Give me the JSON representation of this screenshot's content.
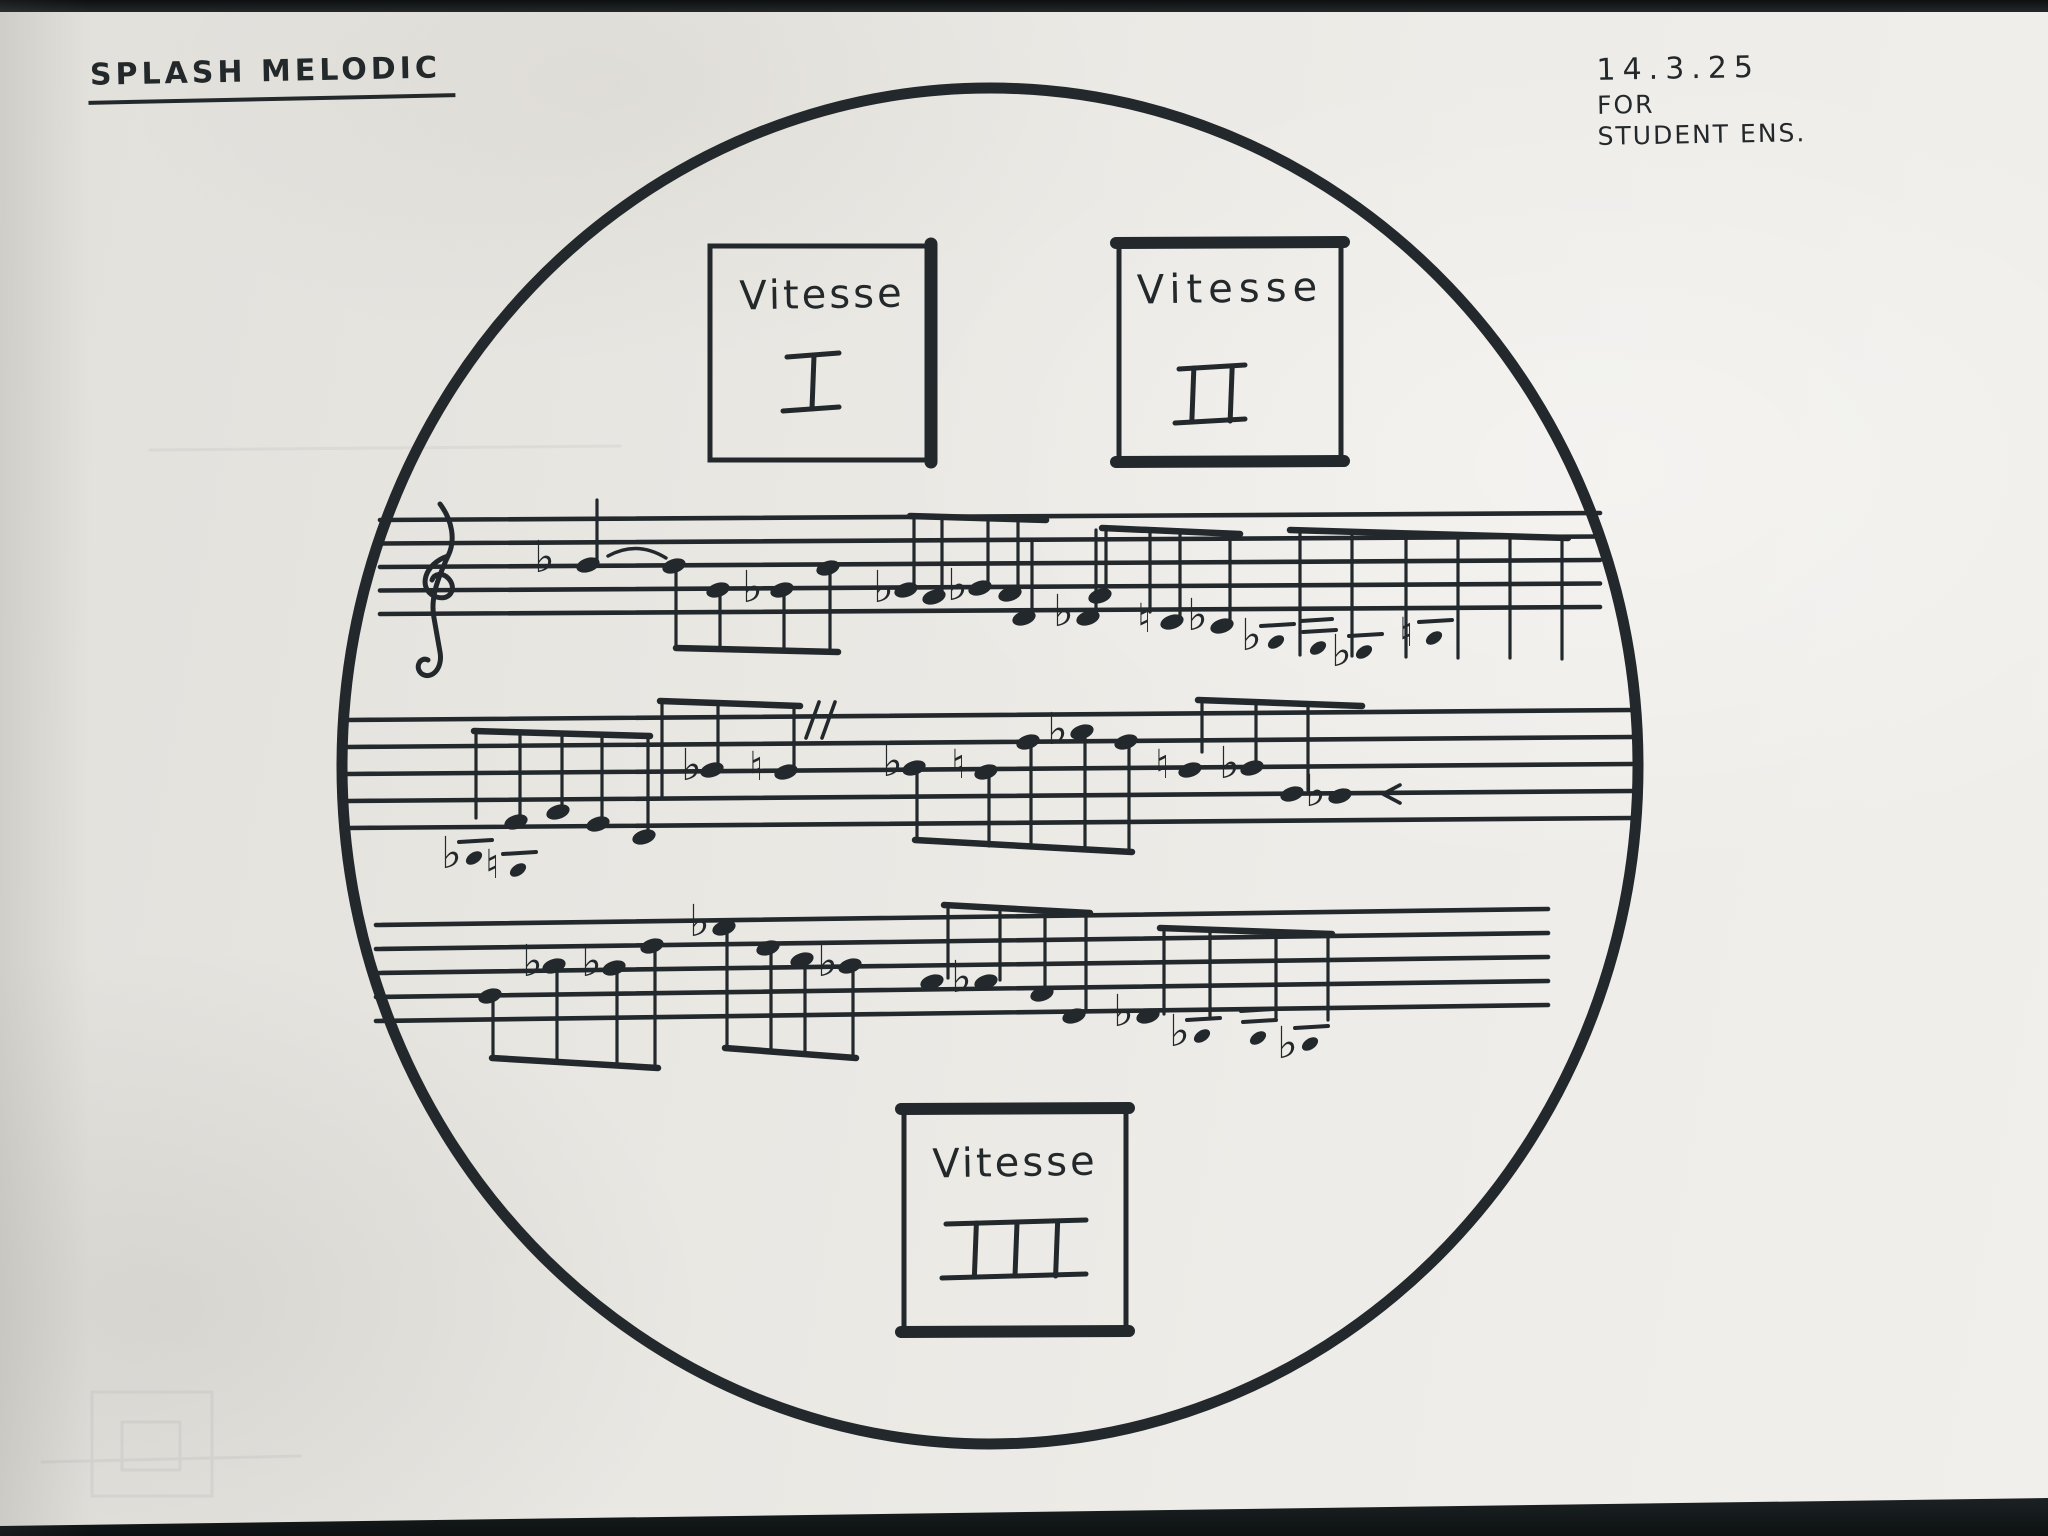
{
  "header": {
    "title": "SPLASH MELODIC",
    "date": "14.3.25",
    "for_line": "FOR",
    "ensemble_line": "STUDENT ENS."
  },
  "colors": {
    "ink": "#22282b",
    "paper": "#ebe9e4",
    "background_strip": "#15191b"
  },
  "boxes": [
    {
      "label": "Vitesse",
      "numeral": "I",
      "x": 710,
      "y": 246,
      "w": 224,
      "h": 214,
      "thick": "right",
      "num_cx": 813,
      "num_cy": 382,
      "num_w": 52
    },
    {
      "label": "Vitesse",
      "numeral": "II",
      "x": 1119,
      "y": 242,
      "w": 222,
      "h": 220,
      "thick": "top-bottom",
      "num_cx": 1212,
      "num_cy": 394,
      "num_w": 66
    },
    {
      "label": "Vitesse",
      "numeral": "III",
      "x": 904,
      "y": 1108,
      "w": 222,
      "h": 224,
      "thick": "top-bottom",
      "num_cx": 1016,
      "num_cy": 1249,
      "num_w": 140
    }
  ],
  "score": {
    "circle": {
      "cx": 990,
      "cy": 766,
      "rx": 648,
      "ry": 678,
      "stroke_w": 11
    },
    "staves": [
      {
        "x1": 380,
        "x2": 1600,
        "top": 520,
        "gap": 23.5,
        "tilt": -7,
        "elements": [
          {
            "t": "clef",
            "x": 436,
            "y": 586
          },
          {
            "t": "flat",
            "x": 545,
            "y": 556
          },
          {
            "t": "head",
            "x": 588,
            "y": 565
          },
          {
            "t": "stem",
            "x": 597,
            "y1": 500,
            "y2": 562
          },
          {
            "t": "tie",
            "x1": 608,
            "y1": 556,
            "x2": 666,
            "y2": 558,
            "dy": -16
          },
          {
            "t": "head",
            "x": 674,
            "y": 566
          },
          {
            "t": "stem",
            "x": 676,
            "y1": 570,
            "y2": 648
          },
          {
            "t": "head",
            "x": 718,
            "y": 590
          },
          {
            "t": "stem",
            "x": 720,
            "y1": 594,
            "y2": 649
          },
          {
            "t": "flat",
            "x": 753,
            "y": 586
          },
          {
            "t": "head",
            "x": 782,
            "y": 590
          },
          {
            "t": "stem",
            "x": 784,
            "y1": 594,
            "y2": 650
          },
          {
            "t": "head",
            "x": 828,
            "y": 568
          },
          {
            "t": "stem",
            "x": 830,
            "y1": 572,
            "y2": 650
          },
          {
            "t": "beam",
            "x1": 676,
            "y1": 648,
            "x2": 838,
            "y2": 652
          },
          {
            "t": "flat",
            "x": 884,
            "y": 586
          },
          {
            "t": "head",
            "x": 906,
            "y": 590
          },
          {
            "t": "stem",
            "x": 914,
            "y1": 516,
            "y2": 586
          },
          {
            "t": "head",
            "x": 934,
            "y": 597
          },
          {
            "t": "stem",
            "x": 942,
            "y1": 517,
            "y2": 593
          },
          {
            "t": "flat",
            "x": 958,
            "y": 584
          },
          {
            "t": "head",
            "x": 980,
            "y": 588
          },
          {
            "t": "stem",
            "x": 988,
            "y1": 518,
            "y2": 584
          },
          {
            "t": "head",
            "x": 1010,
            "y": 594
          },
          {
            "t": "stem",
            "x": 1018,
            "y1": 519,
            "y2": 590
          },
          {
            "t": "beam",
            "x1": 910,
            "y1": 516,
            "x2": 1046,
            "y2": 520
          },
          {
            "t": "head",
            "x": 1024,
            "y": 618
          },
          {
            "t": "stem",
            "x": 1032,
            "y1": 540,
            "y2": 614
          },
          {
            "t": "flat",
            "x": 1064,
            "y": 610
          },
          {
            "t": "head",
            "x": 1088,
            "y": 618
          },
          {
            "t": "stem",
            "x": 1096,
            "y1": 530,
            "y2": 614
          },
          {
            "t": "beam",
            "x1": 1102,
            "y1": 528,
            "x2": 1240,
            "y2": 534
          },
          {
            "t": "head",
            "x": 1100,
            "y": 596
          },
          {
            "t": "stem",
            "x": 1106,
            "y1": 530,
            "y2": 592
          },
          {
            "t": "stem",
            "x": 1150,
            "y1": 531,
            "y2": 612
          },
          {
            "t": "nat",
            "x": 1148,
            "y": 618
          },
          {
            "t": "head",
            "x": 1172,
            "y": 622
          },
          {
            "t": "stem",
            "x": 1180,
            "y1": 532,
            "y2": 618
          },
          {
            "t": "flat",
            "x": 1198,
            "y": 614
          },
          {
            "t": "head",
            "x": 1222,
            "y": 626
          },
          {
            "t": "stem",
            "x": 1230,
            "y1": 533,
            "y2": 622
          },
          {
            "t": "flat",
            "x": 1252,
            "y": 634
          },
          {
            "t": "bar",
            "x": 1276,
            "y": 642
          },
          {
            "t": "bar",
            "x": 1318,
            "y": 648,
            "b2": true
          },
          {
            "t": "flat",
            "x": 1342,
            "y": 650
          },
          {
            "t": "bar",
            "x": 1364,
            "y": 652
          },
          {
            "t": "nat",
            "x": 1410,
            "y": 632
          },
          {
            "t": "bar",
            "x": 1434,
            "y": 638
          },
          {
            "t": "beam",
            "x1": 1290,
            "y1": 530,
            "x2": 1568,
            "y2": 538
          },
          {
            "t": "stem",
            "x": 1300,
            "y1": 532,
            "y2": 655
          },
          {
            "t": "stem",
            "x": 1352,
            "y1": 533,
            "y2": 656
          },
          {
            "t": "stem",
            "x": 1406,
            "y1": 534,
            "y2": 657
          },
          {
            "t": "stem",
            "x": 1458,
            "y1": 535,
            "y2": 658
          },
          {
            "t": "stem",
            "x": 1510,
            "y1": 536,
            "y2": 658
          },
          {
            "t": "stem",
            "x": 1562,
            "y1": 537,
            "y2": 659
          }
        ]
      },
      {
        "x1": 348,
        "x2": 1632,
        "top": 720,
        "gap": 27,
        "tilt": -10,
        "elements": [
          {
            "t": "flat",
            "x": 452,
            "y": 852
          },
          {
            "t": "bar",
            "x": 474,
            "y": 858
          },
          {
            "t": "nat",
            "x": 496,
            "y": 864
          },
          {
            "t": "bar",
            "x": 518,
            "y": 870
          },
          {
            "t": "beam",
            "x1": 474,
            "y1": 731,
            "x2": 650,
            "y2": 736
          },
          {
            "t": "stem",
            "x": 476,
            "y1": 733,
            "y2": 818
          },
          {
            "t": "stem",
            "x": 520,
            "y1": 733,
            "y2": 818
          },
          {
            "t": "head",
            "x": 516,
            "y": 822
          },
          {
            "t": "stem",
            "x": 562,
            "y1": 734,
            "y2": 808
          },
          {
            "t": "head",
            "x": 558,
            "y": 812
          },
          {
            "t": "stem",
            "x": 602,
            "y1": 734,
            "y2": 820
          },
          {
            "t": "head",
            "x": 598,
            "y": 824
          },
          {
            "t": "stem",
            "x": 648,
            "y1": 735,
            "y2": 833
          },
          {
            "t": "head",
            "x": 644,
            "y": 837
          },
          {
            "t": "beam",
            "x1": 660,
            "y1": 701,
            "x2": 800,
            "y2": 706
          },
          {
            "t": "stem",
            "x": 662,
            "y1": 703,
            "y2": 798
          },
          {
            "t": "flat",
            "x": 692,
            "y": 764
          },
          {
            "t": "head",
            "x": 712,
            "y": 770
          },
          {
            "t": "stem",
            "x": 718,
            "y1": 704,
            "y2": 766
          },
          {
            "t": "nat",
            "x": 760,
            "y": 766
          },
          {
            "t": "head",
            "x": 786,
            "y": 772
          },
          {
            "t": "stem",
            "x": 794,
            "y1": 705,
            "y2": 768
          },
          {
            "t": "caes",
            "x": 806,
            "y": 716
          },
          {
            "t": "flat",
            "x": 893,
            "y": 760
          },
          {
            "t": "head",
            "x": 914,
            "y": 768
          },
          {
            "t": "stem",
            "x": 917,
            "y1": 772,
            "y2": 838
          },
          {
            "t": "nat",
            "x": 962,
            "y": 764
          },
          {
            "t": "head",
            "x": 986,
            "y": 772
          },
          {
            "t": "stem",
            "x": 989,
            "y1": 776,
            "y2": 846
          },
          {
            "t": "head",
            "x": 1028,
            "y": 742
          },
          {
            "t": "stem",
            "x": 1031,
            "y1": 746,
            "y2": 848
          },
          {
            "t": "flat",
            "x": 1058,
            "y": 728
          },
          {
            "t": "head",
            "x": 1082,
            "y": 732
          },
          {
            "t": "stem",
            "x": 1085,
            "y1": 736,
            "y2": 850
          },
          {
            "t": "head",
            "x": 1126,
            "y": 742
          },
          {
            "t": "stem",
            "x": 1129,
            "y1": 746,
            "y2": 852
          },
          {
            "t": "beam",
            "x1": 915,
            "y1": 840,
            "x2": 1132,
            "y2": 852
          },
          {
            "t": "beam",
            "x1": 1198,
            "y1": 700,
            "x2": 1362,
            "y2": 706
          },
          {
            "t": "stem",
            "x": 1202,
            "y1": 702,
            "y2": 752
          },
          {
            "t": "nat",
            "x": 1166,
            "y": 764
          },
          {
            "t": "head",
            "x": 1190,
            "y": 770
          },
          {
            "t": "stem",
            "x": 1256,
            "y1": 703,
            "y2": 766
          },
          {
            "t": "flat",
            "x": 1230,
            "y": 762
          },
          {
            "t": "head",
            "x": 1252,
            "y": 768
          },
          {
            "t": "stem",
            "x": 1308,
            "y1": 704,
            "y2": 790
          },
          {
            "t": "head",
            "x": 1292,
            "y": 794
          },
          {
            "t": "flat",
            "x": 1316,
            "y": 790
          },
          {
            "t": "head",
            "x": 1340,
            "y": 796
          },
          {
            "t": "arrow",
            "x": 1383,
            "y": 794
          }
        ]
      },
      {
        "x1": 376,
        "x2": 1548,
        "top": 925,
        "gap": 24,
        "tilt": -16,
        "elements": [
          {
            "t": "head",
            "x": 490,
            "y": 996
          },
          {
            "t": "stem",
            "x": 493,
            "y1": 1000,
            "y2": 1058
          },
          {
            "t": "flat",
            "x": 533,
            "y": 960
          },
          {
            "t": "head",
            "x": 554,
            "y": 966
          },
          {
            "t": "stem",
            "x": 557,
            "y1": 970,
            "y2": 1062
          },
          {
            "t": "flat",
            "x": 592,
            "y": 960
          },
          {
            "t": "head",
            "x": 614,
            "y": 968
          },
          {
            "t": "stem",
            "x": 617,
            "y1": 972,
            "y2": 1064
          },
          {
            "t": "head",
            "x": 652,
            "y": 946
          },
          {
            "t": "stem",
            "x": 655,
            "y1": 950,
            "y2": 1066
          },
          {
            "t": "beam",
            "x1": 492,
            "y1": 1058,
            "x2": 658,
            "y2": 1068
          },
          {
            "t": "flat",
            "x": 700,
            "y": 920
          },
          {
            "t": "head",
            "x": 724,
            "y": 928
          },
          {
            "t": "stem",
            "x": 727,
            "y1": 932,
            "y2": 1048
          },
          {
            "t": "head",
            "x": 768,
            "y": 948
          },
          {
            "t": "stem",
            "x": 771,
            "y1": 952,
            "y2": 1050
          },
          {
            "t": "head",
            "x": 802,
            "y": 960
          },
          {
            "t": "stem",
            "x": 805,
            "y1": 964,
            "y2": 1053
          },
          {
            "t": "flat",
            "x": 828,
            "y": 960
          },
          {
            "t": "head",
            "x": 850,
            "y": 966
          },
          {
            "t": "stem",
            "x": 853,
            "y1": 970,
            "y2": 1056
          },
          {
            "t": "beam",
            "x1": 725,
            "y1": 1048,
            "x2": 856,
            "y2": 1058
          },
          {
            "t": "beam",
            "x1": 944,
            "y1": 905,
            "x2": 1090,
            "y2": 913
          },
          {
            "t": "head",
            "x": 932,
            "y": 982
          },
          {
            "t": "stem",
            "x": 948,
            "y1": 907,
            "y2": 978
          },
          {
            "t": "flat",
            "x": 962,
            "y": 976
          },
          {
            "t": "head",
            "x": 986,
            "y": 982
          },
          {
            "t": "stem",
            "x": 1000,
            "y1": 909,
            "y2": 980
          },
          {
            "t": "head",
            "x": 1042,
            "y": 994
          },
          {
            "t": "stem",
            "x": 1045,
            "y1": 911,
            "y2": 990
          },
          {
            "t": "head",
            "x": 1074,
            "y": 1016
          },
          {
            "t": "stem",
            "x": 1086,
            "y1": 912,
            "y2": 1012
          },
          {
            "t": "flat",
            "x": 1124,
            "y": 1010
          },
          {
            "t": "head",
            "x": 1148,
            "y": 1016
          },
          {
            "t": "beam",
            "x1": 1160,
            "y1": 928,
            "x2": 1332,
            "y2": 934
          },
          {
            "t": "stem",
            "x": 1164,
            "y1": 930,
            "y2": 1014
          },
          {
            "t": "stem",
            "x": 1210,
            "y1": 931,
            "y2": 1016
          },
          {
            "t": "stem",
            "x": 1276,
            "y1": 932,
            "y2": 1018
          },
          {
            "t": "stem",
            "x": 1328,
            "y1": 933,
            "y2": 1020
          },
          {
            "t": "flat",
            "x": 1180,
            "y": 1030
          },
          {
            "t": "bar",
            "x": 1202,
            "y": 1036
          },
          {
            "t": "bar",
            "x": 1258,
            "y": 1038,
            "b2": true
          },
          {
            "t": "flat",
            "x": 1288,
            "y": 1042
          },
          {
            "t": "bar",
            "x": 1310,
            "y": 1044
          }
        ]
      }
    ]
  }
}
